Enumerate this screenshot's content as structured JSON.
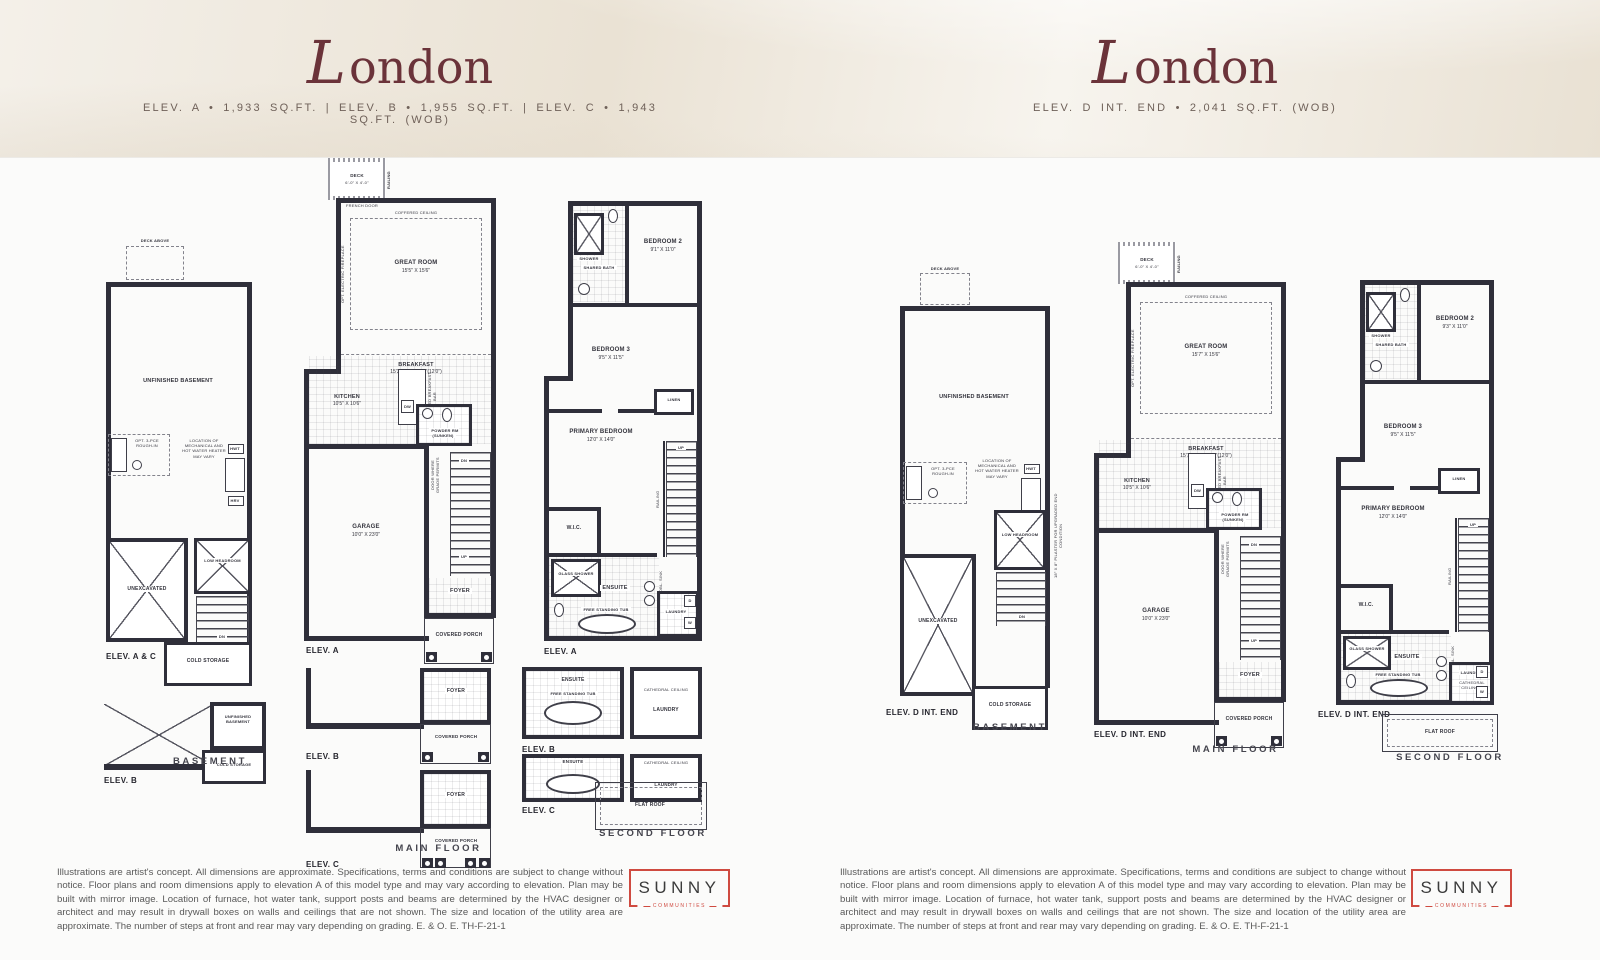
{
  "header": {
    "left_title": "London",
    "left_subtitle": "ELEV. A  •  1,933 SQ.FT.   |   ELEV. B  •  1,955 SQ.FT.   |   ELEV. C  •  1,943 SQ.FT. (WOB)",
    "right_title": "London",
    "right_subtitle": "ELEV. D INT. END  •  2,041 SQ.FT. (WOB)"
  },
  "labels": {
    "deck_above": "DECK ABOVE",
    "unfinished_basement": "UNFINISHED BASEMENT",
    "mech_note": "LOCATION OF MECHANICAL AND HOT WATER HEATER MAY VARY",
    "rough_in": "OPT. 3-PCE ROUGH-IN",
    "low_headroom": "LOW HEADROOM",
    "unexcavated": "UNEXCAVATED",
    "cold_storage": "COLD STORAGE",
    "hwt": "HWT",
    "hrv": "HRV",
    "basement_caption": "BASEMENT",
    "main_caption": "MAIN FLOOR",
    "second_caption": "SECOND FLOOR",
    "deck": "DECK",
    "deck_dim": "6'-0\" X 4'-0\"",
    "railing": "RAILING",
    "french_door": "FRENCH DOOR",
    "coffered": "COFFERED CEILING",
    "great_room": "GREAT ROOM",
    "fireplace": "OPT. ELECTRIC FIREPLACE",
    "breakfast": "BREAKFAST",
    "kitchen": "KITCHEN",
    "kitchen_dim": "10'5\" X 10'6\"",
    "ext_bar": "EXTENDED BREAKFAST BAR",
    "dw": "DW",
    "powder": "POWDER RM (SUNKEN)",
    "door_grade": "DOOR WHERE GRADE PERMITS",
    "garage": "GARAGE",
    "garage_dim": "10'0\" X 23'0\"",
    "foyer": "FOYER",
    "porch": "COVERED PORCH",
    "up": "UP",
    "dn": "DN",
    "shower": "SHOWER",
    "shared_bath": "SHARED BATH",
    "bedroom2": "BEDROOM 2",
    "bedroom3": "BEDROOM 3",
    "bedroom3_dim": "9'5\" X 11'5\"",
    "linen": "LINEN",
    "primary": "PRIMARY BEDROOM",
    "primary_dim": "12'0\" X 14'0\"",
    "wic": "W.I.C.",
    "glass_shower": "GLASS SHOWER",
    "ensuite": "ENSUITE",
    "tub": "FREE STANDING TUB",
    "dbl_sink": "OPT. DBL. SINK",
    "laundry": "LAUNDRY",
    "cathedral": "CATHEDRAL CEILING",
    "flat_roof": "FLAT ROOF",
    "w": "W",
    "d": "D",
    "pilaster": "18\" X 8\" PILASTER FOR UPGRADED END CONDITION",
    "elev_a": "ELEV. A",
    "elev_b": "ELEV. B",
    "elev_c": "ELEV. C",
    "elev_ac": "ELEV. A & C",
    "elev_d": "ELEV. D INT. END"
  },
  "left": {
    "great_room_dim": "15'5\" X 15'6\"",
    "breakfast_dim": "15'3\"(9'7\") X 7'9\"(12'0\")",
    "bedroom2_dim": "9'1\" X 11'0\""
  },
  "right": {
    "great_room_dim": "15'7\" X 15'6\"",
    "breakfast_dim": "15'7\"(9'8\") X 7'9\"(12'0\")",
    "bedroom2_dim": "9'3\" X 11'0\""
  },
  "footer": {
    "disclaimer": "Illustrations are artist's concept. All dimensions are approximate. Specifications, terms and conditions are subject to change without notice. Floor plans and room dimensions apply to elevation A of this model type and may vary according to elevation. Plan may be built with mirror image. Location of furnace, hot water tank, support posts and beams are determined by the HVAC designer or architect and may result in drywall boxes on walls and ceilings that are not shown. The size and location of the utility area are approximate. The number of steps at front and rear may vary depending on grading. E. & O. E. TH-F-21-1",
    "logo_name": "SUNNY",
    "logo_tagline": "COMMUNITIES"
  }
}
